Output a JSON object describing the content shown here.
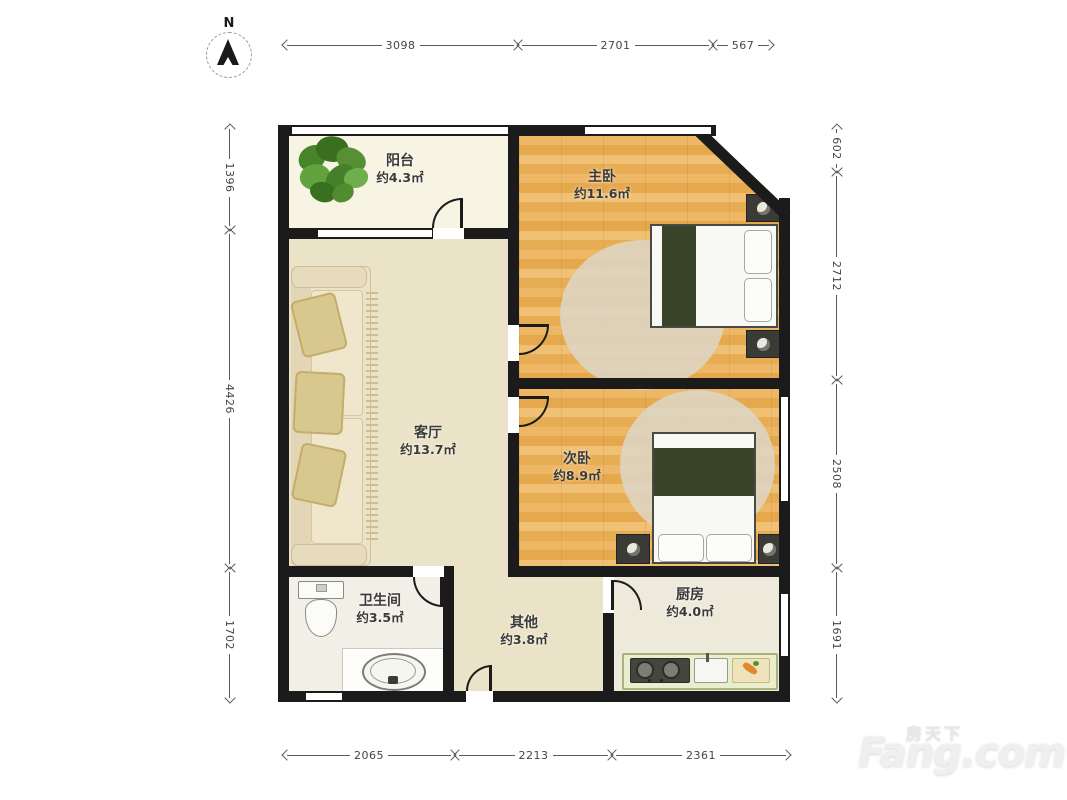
{
  "compass": {
    "label": "N"
  },
  "rooms": {
    "balcony": {
      "name": "阳台",
      "area": "约4.3㎡"
    },
    "master": {
      "name": "主卧",
      "area": "约11.6㎡"
    },
    "living": {
      "name": "客厅",
      "area": "约13.7㎡"
    },
    "second": {
      "name": "次卧",
      "area": "约8.9㎡"
    },
    "bathroom": {
      "name": "卫生间",
      "area": "约3.5㎡"
    },
    "other": {
      "name": "其他",
      "area": "约3.8㎡"
    },
    "kitchen": {
      "name": "厨房",
      "area": "约4.0㎡"
    }
  },
  "dimensions": {
    "top": [
      "3098",
      "2701",
      "567"
    ],
    "left": [
      "1396",
      "4426",
      "1702"
    ],
    "right": [
      "602",
      "2712",
      "2508",
      "1691"
    ],
    "bottom": [
      "2065",
      "2213",
      "2361"
    ]
  },
  "watermark": {
    "cn": "房天下",
    "en": "Fang.com"
  },
  "colors": {
    "wall": "#1b1b1b",
    "wood_floor": "#e9b25c",
    "tile_floor": "#ebe3c7",
    "balcony_floor": "#f7f4e3",
    "kitchen_counter": "#e9efcd",
    "blanket": "#3a4429",
    "dimension_text": "#454545"
  }
}
